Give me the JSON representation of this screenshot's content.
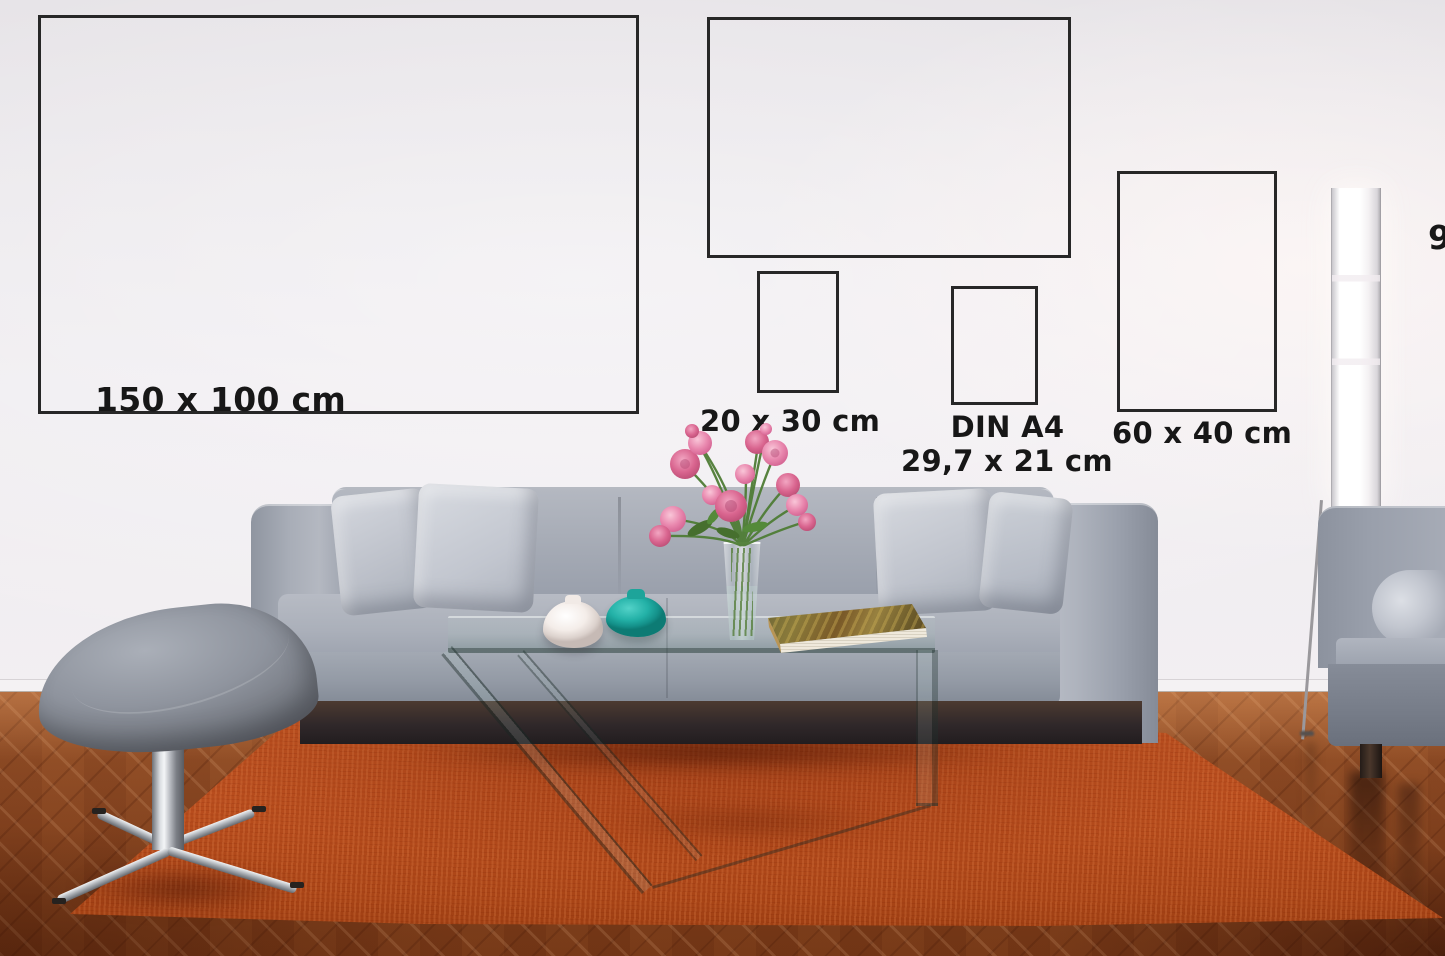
{
  "size_guide": {
    "frames": [
      {
        "name": "150x100",
        "label": "150 x 100 cm"
      },
      {
        "name": "90x60",
        "label": "90 x 60 cm"
      },
      {
        "name": "20x30",
        "label": "20 x 30 cm"
      },
      {
        "name": "din-a4",
        "label": "DIN A4",
        "sublabel": "29,7 x 21 cm"
      },
      {
        "name": "60x40",
        "label": "60 x 40 cm"
      }
    ]
  },
  "colors": {
    "wall": "#eceaed",
    "frame_border": "#272727",
    "label_text": "#171717",
    "rug": "#ba4e1e",
    "floor_wood": "#7e3f1d",
    "sofa": "#9aa0ac",
    "pillow": "#c9cdd5",
    "teal_vase": "#23b1a7",
    "white_vase": "#f4ede9",
    "flower_pink": "#e27ba4",
    "lamp": "#ffffff"
  }
}
